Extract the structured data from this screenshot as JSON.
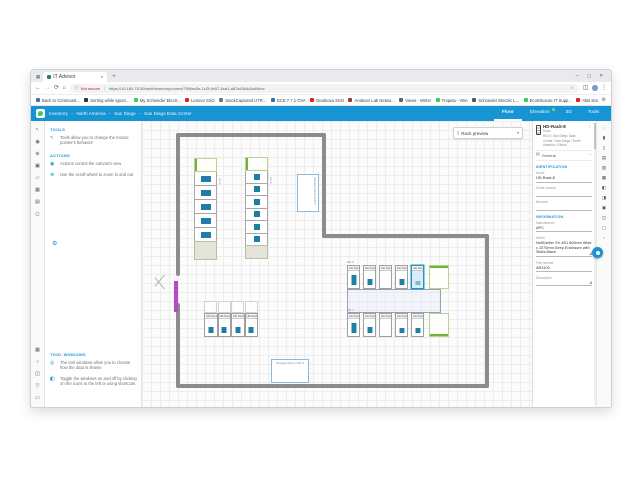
{
  "icons": {
    "window_menu": "▦",
    "tab_close": "✕",
    "new_tab": "+",
    "minimize": "─",
    "maximize": "▢",
    "close": "✕",
    "back": "←",
    "forward": "→",
    "refresh": "⟳",
    "home": "⌂",
    "info": "ⓘ",
    "star": "☆",
    "split": "◫",
    "kebab": "⋮",
    "gear": "⚙",
    "rack_preview": "▯",
    "caret_down": "▾",
    "caret_up": "⌃",
    "general": "▤"
  },
  "browser": {
    "tab_title": "IT Advisor",
    "address": {
      "security_label": "Not secure",
      "url": "https://10.160.78.30/web/inventory/rooms/795faa3e-1c2f-4e57-8ca1-a87a93d4d4cf/floor"
    },
    "bookmarks": [
      {
        "label": "Back to Communit...",
        "color": "#4a6fa5"
      },
      {
        "label": "Sorting while Ignori...",
        "color": "#333333"
      },
      {
        "label": "My Schneider Electr...",
        "color": "#3dcd58"
      },
      {
        "label": "Lenovo SSO",
        "color": "#e2231a"
      },
      {
        "label": "StackCaptured UTR...",
        "color": "#777777"
      },
      {
        "label": "DCE 7.7.1 OVA",
        "color": "#2f6fb2"
      },
      {
        "label": "Dealnova SSO",
        "color": "#e2231a"
      },
      {
        "label": "Andover Lab Netwo...",
        "color": "#9c3b3b"
      },
      {
        "label": "Views - Writer",
        "color": "#666666"
      },
      {
        "label": "Tropela - VBA",
        "color": "#3dcd58"
      },
      {
        "label": "Schneider Electric L...",
        "color": "#555555"
      },
      {
        "label": "EcoStruxure IT Supp...",
        "color": "#3dcd58"
      },
      {
        "label": "Altis simulator",
        "color": "#e2231a"
      }
    ]
  },
  "app": {
    "header": {
      "breadcrumb": [
        "Inventory",
        "North America",
        "San Diego",
        "San Diego Data Center"
      ],
      "separator": "–",
      "tabs": [
        {
          "label": "Floor",
          "active": true,
          "badge": false
        },
        {
          "label": "Elevation",
          "active": false,
          "badge": true
        },
        {
          "label": "3D",
          "active": false,
          "badge": false
        },
        {
          "label": "Tools",
          "active": false,
          "badge": false
        }
      ]
    },
    "left_strip": {
      "top": [
        {
          "name": "pointer-tool-icon",
          "glyph": "↖",
          "active": true
        },
        {
          "name": "pan-tool-icon",
          "glyph": "◉",
          "active": false
        },
        {
          "name": "zoom-tool-icon",
          "glyph": "⊕",
          "active": false
        },
        {
          "name": "add-rack-tool-icon",
          "glyph": "▣",
          "active": false
        },
        {
          "name": "edit-tool-icon",
          "glyph": "▱",
          "active": false
        },
        {
          "name": "power-tool-icon",
          "glyph": "▦",
          "active": false
        },
        {
          "name": "notes-tool-icon",
          "glyph": "▤",
          "active": false
        },
        {
          "name": "fit-view-icon",
          "glyph": "◻",
          "active": false
        }
      ],
      "bottom": [
        {
          "name": "layers-window-icon",
          "glyph": "▦",
          "active": false
        },
        {
          "name": "search-window-icon",
          "glyph": "○",
          "active": false
        },
        {
          "name": "properties-window-icon",
          "glyph": "◫",
          "active": false
        },
        {
          "name": "download-icon",
          "glyph": "▽",
          "active": false
        },
        {
          "name": "print-icon",
          "glyph": "▭",
          "active": false
        }
      ]
    },
    "left_panel": {
      "sections": [
        {
          "heading": "TOOLS",
          "items": [
            {
              "name": "tools-help",
              "icon": "↖",
              "text": "Tools allow you to change the mouse pointer's behavior"
            }
          ]
        },
        {
          "heading": "ACTIONS",
          "items": [
            {
              "name": "actions-help",
              "icon": "◉",
              "text": "Actions control the canvas's view"
            },
            {
              "name": "scroll-help",
              "icon": "⊕",
              "text": "Use the scroll wheel to zoom in and out"
            }
          ]
        },
        {
          "heading": "TOOL WINDOWS",
          "items": [
            {
              "name": "tool-windows-help",
              "icon": "◎",
              "text": "The tool windows allow you to choose how the data is shown"
            },
            {
              "name": "toggle-help",
              "icon": "◧",
              "text": "Toggle the windows on and off by clicking on the icons to the left or using shortcuts"
            }
          ]
        }
      ]
    },
    "canvas": {
      "rack_preview_label": "Rack preview",
      "floorplan": {
        "rows": [
          {
            "label": "HA 1",
            "type": "v",
            "x": 52,
            "y": 37,
            "w": 23,
            "unit_h": 14,
            "racks": 5,
            "rack_h": 15,
            "strip_h": 19,
            "dev_w": 10,
            "dev_h": 6
          },
          {
            "label": "HA 2",
            "type": "v",
            "x": 103,
            "y": 36,
            "w": 23,
            "unit_h": 14,
            "racks": 6,
            "rack_h": 13.5,
            "strip_h": 14,
            "dev_w": 6,
            "dev_h": 6
          },
          {
            "label": "HD 6",
            "type": "h",
            "x": 205,
            "y": 144,
            "h": 24,
            "rack_w": 13,
            "gap": 3,
            "racks": [
              "HD-Rack-4",
              "HD-Rack-5",
              "HD-Rack-6",
              "HD-Rack-7",
              "HD-Rack-8"
            ],
            "devs": [
              10,
              6,
              0,
              6,
              4
            ],
            "selected": "HD-Rack-8",
            "cab_w": 20,
            "green": "top"
          },
          {
            "label": "HD 7",
            "type": "h",
            "x": 205,
            "y": 192,
            "h": 24,
            "rack_w": 13,
            "gap": 3,
            "racks": [
              "HD-Rack-9",
              "HD-Rack-10",
              "HD-Rack-11",
              "HD-Rack-12",
              "HD-Rack-13"
            ],
            "devs": [
              10,
              6,
              0,
              5,
              5
            ],
            "cab_w": 20,
            "green": "bottom"
          },
          {
            "label": "",
            "type": "h",
            "x": 62,
            "y": 192,
            "h": 24,
            "rack_w": 13.5,
            "gap": 0,
            "racks": [
              "HB-Rack-1",
              "HB-Rack-2",
              "HB-Rack-3",
              "HB-Rack-4"
            ],
            "devs": [
              6,
              6,
              6,
              6
            ],
            "overhead": true
          }
        ],
        "aisle": {
          "x": 205,
          "y": 168,
          "w": 94,
          "h": 24
        },
        "annotations": [
          {
            "text": "Storage Room HW 3",
            "x": 155,
            "y": 53,
            "w": 22,
            "h": 38,
            "vertical": true
          },
          {
            "text": "Storage Room HW 4",
            "x": 129,
            "y": 238,
            "w": 38,
            "h": 24,
            "vertical": false
          }
        ]
      }
    },
    "right_panel": {
      "title": "HD-Rack-8",
      "subtitle": "Rack",
      "location": "HD 6 / San Diego Data Center / San Diego / North America / Global",
      "section_label": "General",
      "groups": [
        {
          "heading": "IDENTIFICATION",
          "fields": [
            {
              "label": "Name",
              "value": "HD-Rack-8",
              "type": "input"
            },
            {
              "label": "Serial number",
              "value": "",
              "type": "input"
            },
            {
              "label": "Barcode",
              "value": "",
              "type": "input"
            }
          ]
        },
        {
          "heading": "INFORMATION",
          "fields": [
            {
              "label": "Manufacturer",
              "value": "APC",
              "type": "input"
            },
            {
              "label": "Model",
              "value": "NetShelter SX 42U 600mm Wide x 1070mm Deep Enclosure with Sides Black",
              "type": "textarea"
            },
            {
              "label": "Part number",
              "value": "AR3100",
              "type": "input"
            },
            {
              "label": "Description",
              "value": "",
              "type": "textarea"
            }
          ]
        }
      ]
    },
    "right_strip": {
      "icons": [
        {
          "name": "more-icon",
          "glyph": "⋮"
        },
        {
          "name": "rack-genome-icon",
          "glyph": "▮"
        },
        {
          "name": "open-frame-icon",
          "glyph": "▯"
        },
        {
          "name": "shelf-icon",
          "glyph": "▤"
        },
        {
          "name": "pdu-icon",
          "glyph": "▥"
        },
        {
          "name": "ups-icon",
          "glyph": "▦"
        },
        {
          "name": "cooling-icon",
          "glyph": "◧"
        },
        {
          "name": "panel-icon",
          "glyph": "◨"
        },
        {
          "name": "server-icon",
          "glyph": "▣"
        },
        {
          "name": "network-icon",
          "glyph": "◫"
        },
        {
          "name": "sensor-icon",
          "glyph": "▢"
        },
        {
          "name": "blanking-icon",
          "glyph": "▫"
        }
      ]
    }
  }
}
